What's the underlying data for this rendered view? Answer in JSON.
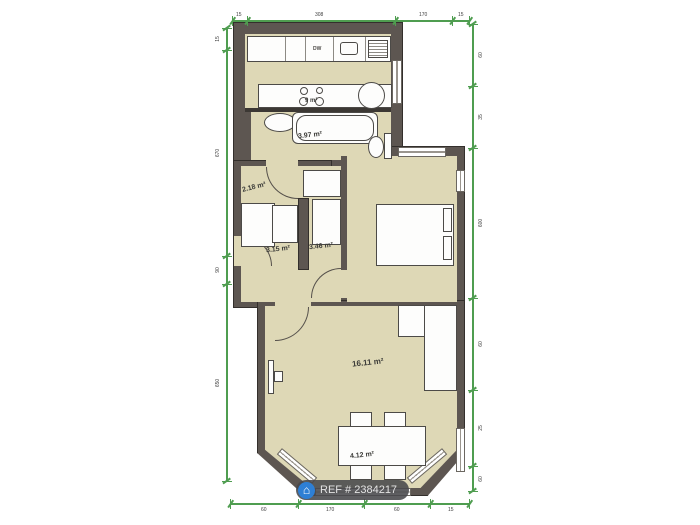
{
  "plan": {
    "watermark": {
      "label": "REF # 2384217",
      "icon": "home-icon"
    },
    "rooms": {
      "kitchen": {
        "area": "9 m²"
      },
      "bathroom": {
        "area": "3.97 m²"
      },
      "hall": {
        "area": "2.18 m²"
      },
      "inner_hall": {
        "area": "3.15 m²"
      },
      "closet": {
        "area": "3.46 m²"
      },
      "living": {
        "area": "16.11 m²"
      },
      "bay": {
        "area": "4.12 m²"
      }
    },
    "labels": {
      "dishwasher": "DW"
    },
    "dims": {
      "top": [
        "15",
        "308",
        "170",
        "15"
      ],
      "left": [
        "15",
        "670",
        "90",
        "650"
      ],
      "right": [
        "60",
        "35",
        "600",
        "60",
        "25",
        "60"
      ],
      "bottom": [
        "60",
        "170",
        "60",
        "15"
      ]
    },
    "colors": {
      "wall": "#5d5651",
      "floor": "#ded8b6",
      "dimension": "#4f9d50",
      "watermark_icon": "#2e7fd4"
    }
  }
}
